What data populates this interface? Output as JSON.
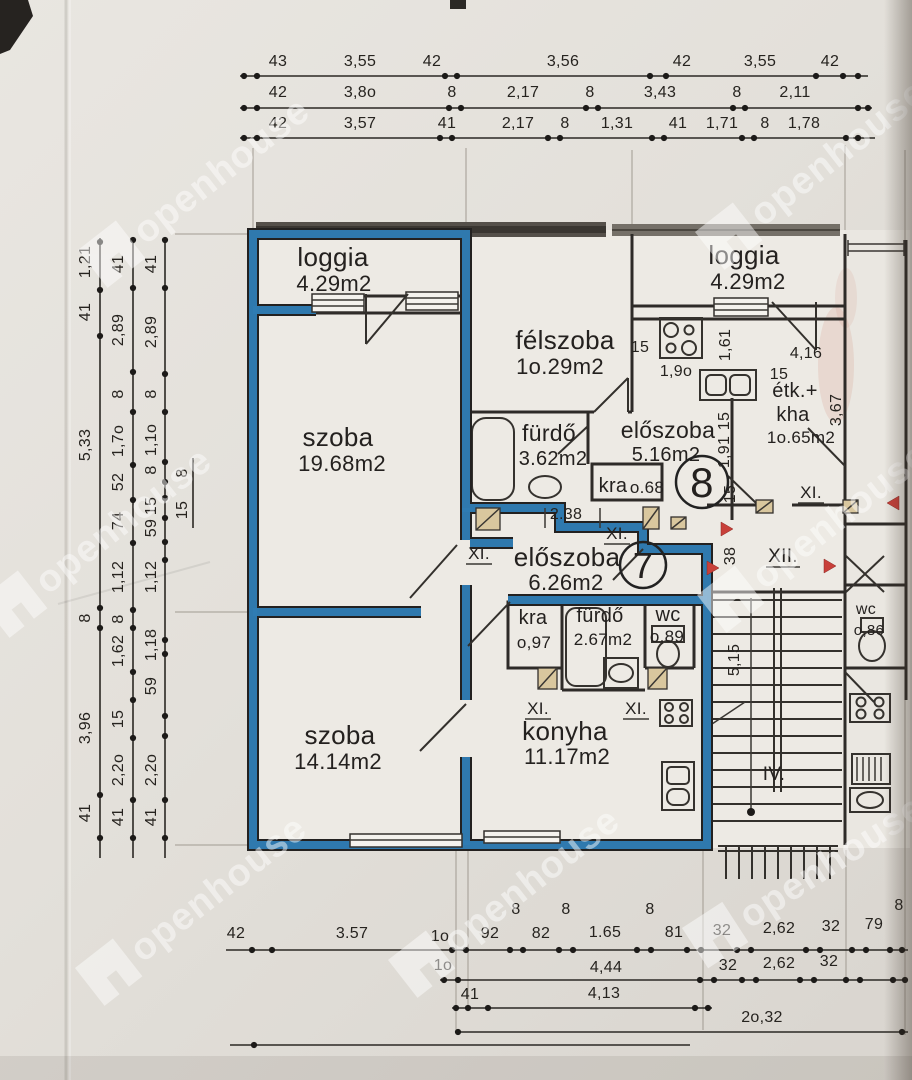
{
  "watermark": {
    "text": "openhouse"
  },
  "colors": {
    "apartment_highlight": "#2f7cb3",
    "door_marker_red": "#c8403a",
    "door_sill_tan": "#d9c79e",
    "paper": "#e3e0da"
  },
  "rooms": [
    {
      "id": "loggia_left",
      "name": "loggia",
      "area": "4.29m2"
    },
    {
      "id": "szoba_large",
      "name": "szoba",
      "area": "19.68m2"
    },
    {
      "id": "felszoba",
      "name": "félszoba",
      "area": "1o.29m2"
    },
    {
      "id": "furdo_upper",
      "name": "fürdő",
      "area": "3.62m2"
    },
    {
      "id": "eloszoba_upper",
      "name": "előszoba",
      "area": "5.16m2"
    },
    {
      "id": "kra_upper",
      "name": "kra",
      "area": "o.68"
    },
    {
      "id": "loggia_right",
      "name": "loggia",
      "area": "4.29m2"
    },
    {
      "id": "etk_kha",
      "name": "étk.+",
      "name2": "kha",
      "area": "1o.65m2"
    },
    {
      "id": "eloszoba_lower",
      "name": "előszoba",
      "area": "6.26m2"
    },
    {
      "id": "kra_lower",
      "name": "kra",
      "area": "o,97"
    },
    {
      "id": "furdo_lower",
      "name": "fürdő",
      "area": "2.67m2"
    },
    {
      "id": "wc_lower",
      "name": "wc",
      "area": "o,89"
    },
    {
      "id": "konyha",
      "name": "konyha",
      "area": "11.17m2"
    },
    {
      "id": "szoba_small",
      "name": "szoba",
      "area": "14.14m2"
    },
    {
      "id": "wc_stair",
      "name": "wc",
      "area": "o,86"
    }
  ],
  "units": {
    "apt7": "7",
    "apt8": "8"
  },
  "marks": {
    "xi": "XI.",
    "xii": "XII.",
    "iv": "IV."
  },
  "plan_dims": {
    "n15": "15",
    "n190": "1,9o",
    "n161": "1,61",
    "n416": "4,16",
    "n367": "3,67",
    "n191": "1,91",
    "n38": "38",
    "n515": "5,15",
    "n238": "2.38"
  },
  "dims_top": {
    "row1": [
      "43",
      "3,55",
      "42",
      "3,56",
      "42",
      "3,55",
      "42"
    ],
    "row2": [
      "42",
      "3,8o",
      "8",
      "2,17",
      "8",
      "3,43",
      "8",
      "2,11"
    ],
    "row3": [
      "42",
      "3,57",
      "41",
      "2,17",
      "8",
      "1,31",
      "41",
      "1,71",
      "8",
      "1,78"
    ]
  },
  "dims_left": {
    "c1": [
      "1,21",
      "41",
      "5,33",
      "8",
      "3,96",
      "41"
    ],
    "c2": [
      "41",
      "2,89",
      "8",
      "1,7o",
      "52",
      "74",
      "1,12",
      "8",
      "1,62",
      "15",
      "2,2o",
      "41"
    ],
    "c3": [
      "41",
      "2,89",
      "8",
      "1,1o",
      "8",
      "15",
      "59",
      "1,12",
      "1,18",
      "59",
      "2,2o",
      "41"
    ],
    "c4": [
      "8",
      "15"
    ]
  },
  "dims_bottom": {
    "row1": [
      "42",
      "3.57",
      "1o",
      "92",
      "8",
      "82",
      "8",
      "1.65",
      "8",
      "81",
      "32",
      "2,62",
      "32",
      "79",
      "8"
    ],
    "row2": [
      "1o",
      "4,44",
      "32",
      "2,62",
      "32"
    ],
    "row3": [
      "41",
      "4,13"
    ],
    "row4": [
      "2o,32"
    ]
  }
}
